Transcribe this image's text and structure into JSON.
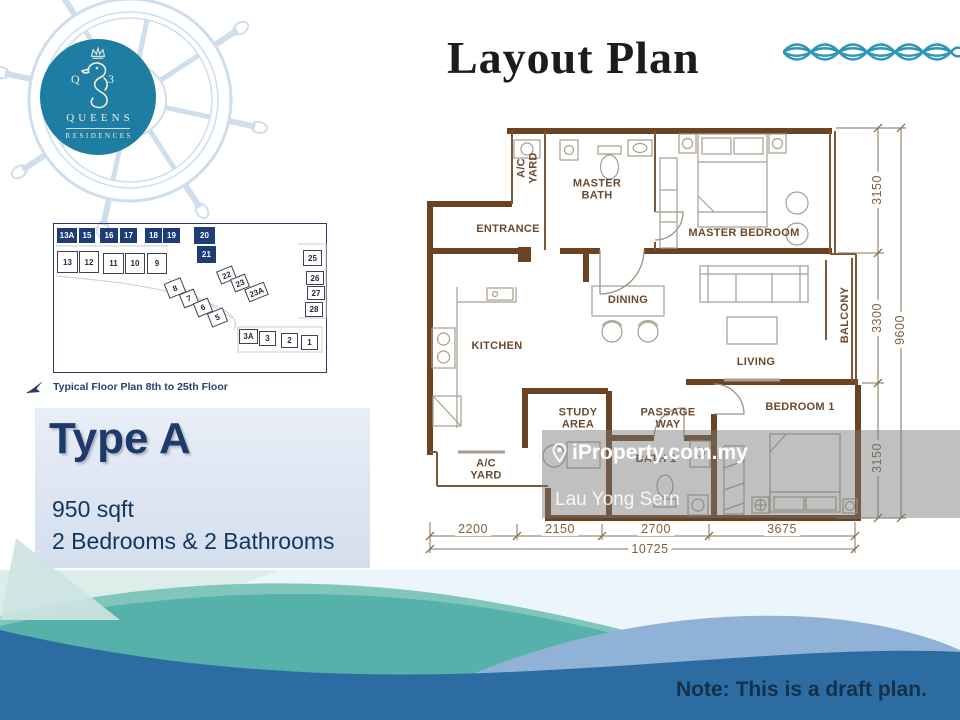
{
  "header": {
    "title": "Layout Plan"
  },
  "logo": {
    "monogram_left": "Q",
    "monogram_right": "3",
    "name_line1": "QUEENS",
    "name_line2": "RESIDENCES"
  },
  "site_plan": {
    "caption": "Typical Floor Plan 8th to 25th Floor",
    "units": [
      {
        "label": "13A",
        "x": 57,
        "y": 228,
        "w": 20,
        "h": 15,
        "hl": true
      },
      {
        "label": "15",
        "x": 79,
        "y": 228,
        "w": 16,
        "h": 15,
        "hl": true
      },
      {
        "label": "16",
        "x": 100,
        "y": 228,
        "w": 18,
        "h": 15,
        "hl": true
      },
      {
        "label": "17",
        "x": 120,
        "y": 228,
        "w": 17,
        "h": 15,
        "hl": true
      },
      {
        "label": "18",
        "x": 145,
        "y": 228,
        "w": 17,
        "h": 15,
        "hl": true
      },
      {
        "label": "19",
        "x": 163,
        "y": 228,
        "w": 17,
        "h": 15,
        "hl": true
      },
      {
        "label": "20",
        "x": 194,
        "y": 227,
        "w": 21,
        "h": 17,
        "hl": true
      },
      {
        "label": "21",
        "x": 197,
        "y": 246,
        "w": 19,
        "h": 17,
        "hl": true
      },
      {
        "label": "13",
        "x": 57,
        "y": 251,
        "w": 21,
        "h": 22
      },
      {
        "label": "12",
        "x": 79,
        "y": 251,
        "w": 20,
        "h": 22
      },
      {
        "label": "11",
        "x": 103,
        "y": 253,
        "w": 21,
        "h": 21
      },
      {
        "label": "10",
        "x": 125,
        "y": 253,
        "w": 20,
        "h": 21
      },
      {
        "label": "9",
        "x": 147,
        "y": 253,
        "w": 20,
        "h": 21
      },
      {
        "label": "8",
        "x": 166,
        "y": 280,
        "w": 18,
        "h": 16,
        "rot": -22
      },
      {
        "label": "7",
        "x": 181,
        "y": 291,
        "w": 16,
        "h": 15,
        "rot": -22
      },
      {
        "label": "6",
        "x": 195,
        "y": 300,
        "w": 16,
        "h": 15,
        "rot": -22
      },
      {
        "label": "5",
        "x": 209,
        "y": 310,
        "w": 17,
        "h": 15,
        "rot": -22
      },
      {
        "label": "22",
        "x": 218,
        "y": 268,
        "w": 17,
        "h": 14,
        "rot": -22
      },
      {
        "label": "23",
        "x": 232,
        "y": 276,
        "w": 16,
        "h": 14,
        "rot": -22
      },
      {
        "label": "23A",
        "x": 246,
        "y": 285,
        "w": 21,
        "h": 14,
        "rot": -22
      },
      {
        "label": "25",
        "x": 303,
        "y": 250,
        "w": 19,
        "h": 16
      },
      {
        "label": "26",
        "x": 306,
        "y": 271,
        "w": 18,
        "h": 14
      },
      {
        "label": "27",
        "x": 307,
        "y": 286,
        "w": 18,
        "h": 14
      },
      {
        "label": "28",
        "x": 305,
        "y": 302,
        "w": 18,
        "h": 15
      },
      {
        "label": "3A",
        "x": 239,
        "y": 329,
        "w": 19,
        "h": 15
      },
      {
        "label": "3",
        "x": 259,
        "y": 331,
        "w": 17,
        "h": 15
      },
      {
        "label": "2",
        "x": 281,
        "y": 333,
        "w": 17,
        "h": 15
      },
      {
        "label": "1",
        "x": 301,
        "y": 335,
        "w": 17,
        "h": 15
      }
    ]
  },
  "type_panel": {
    "title": "Type A",
    "area": "950 sqft",
    "config": "2 Bedrooms & 2 Bathrooms"
  },
  "floor_plan": {
    "rooms": [
      {
        "label": "A/C\nYARD",
        "x": 528,
        "y": 168,
        "rot": -90
      },
      {
        "label": "MASTER\nBATH",
        "x": 597,
        "y": 190
      },
      {
        "label": "ENTRANCE",
        "x": 508,
        "y": 229
      },
      {
        "label": "MASTER BEDROOM",
        "x": 744,
        "y": 233
      },
      {
        "label": "DINING",
        "x": 628,
        "y": 300
      },
      {
        "label": "KITCHEN",
        "x": 497,
        "y": 346
      },
      {
        "label": "LIVING",
        "x": 756,
        "y": 362
      },
      {
        "label": "BALCONY",
        "x": 845,
        "y": 315,
        "rot": -90
      },
      {
        "label": "STUDY\nAREA",
        "x": 578,
        "y": 419
      },
      {
        "label": "PASSAGE\nWAY",
        "x": 668,
        "y": 419
      },
      {
        "label": "BEDROOM 1",
        "x": 800,
        "y": 407
      },
      {
        "label": "BATH 1",
        "x": 656,
        "y": 459
      },
      {
        "label": "A/C\nYARD",
        "x": 486,
        "y": 470
      }
    ],
    "dimensions": {
      "bottom": [
        {
          "label": "2200",
          "x": 473
        },
        {
          "label": "2150",
          "x": 560
        },
        {
          "label": "2700",
          "x": 656
        },
        {
          "label": "3675",
          "x": 782
        }
      ],
      "bottom_total": {
        "label": "10725",
        "x": 650,
        "y": 549
      },
      "right": [
        {
          "label": "3150",
          "y": 190
        },
        {
          "label": "3300",
          "y": 318
        },
        {
          "label": "3150",
          "y": 458
        }
      ],
      "right_total": {
        "label": "9600",
        "y": 330
      }
    }
  },
  "watermark": {
    "brand": "iProperty.com.my",
    "agent": "Lau Yong Sern"
  },
  "note": {
    "text": "Note: This is a draft plan."
  },
  "colors": {
    "logo_teal": "#1d7da3",
    "wall_brown": "#6b4323",
    "highlight_navy": "#1e3d74",
    "wave_teal": "#55b1aa",
    "wave_blue": "#2d6ca3",
    "accent_navy": "#1e3a6a"
  }
}
